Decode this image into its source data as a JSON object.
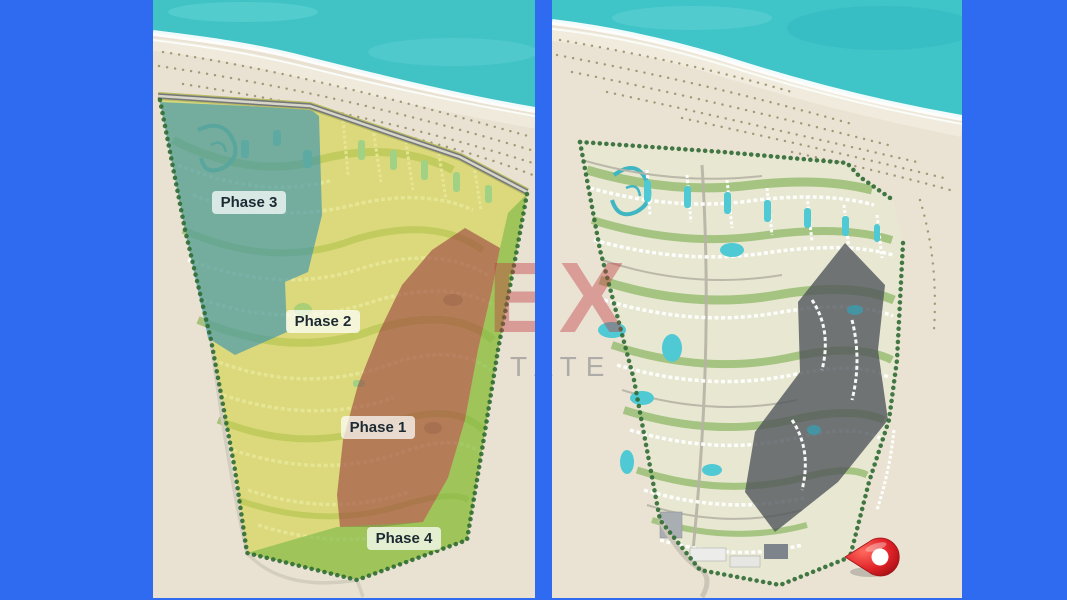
{
  "title": "Seaside masterplan — phasing map and location map",
  "background_color": "#2e6bf0",
  "left_map": {
    "description": "masterplan with colored phase overlays",
    "phases": [
      {
        "id": "phase-1",
        "label": "Phase 1",
        "color": "#9c4341"
      },
      {
        "id": "phase-2",
        "label": "Phase 2",
        "color": "#d5d44a"
      },
      {
        "id": "phase-3",
        "label": "Phase 3",
        "color": "#2f8fb4"
      },
      {
        "id": "phase-4",
        "label": "Phase 4",
        "color": "#74b545"
      }
    ]
  },
  "right_map": {
    "description": "masterplan with highlighted parcel and location pin",
    "highlight_color": "#51565b",
    "pin_color": "#e02127",
    "sea_color": "#3fc4c8",
    "sand_color": "#eae3d4"
  },
  "watermark": {
    "line1": "EXT",
    "line2": "TATE",
    "line1_color": "rgba(193,57,64,0.42)",
    "line2_color": "rgba(126,126,132,0.55)"
  }
}
